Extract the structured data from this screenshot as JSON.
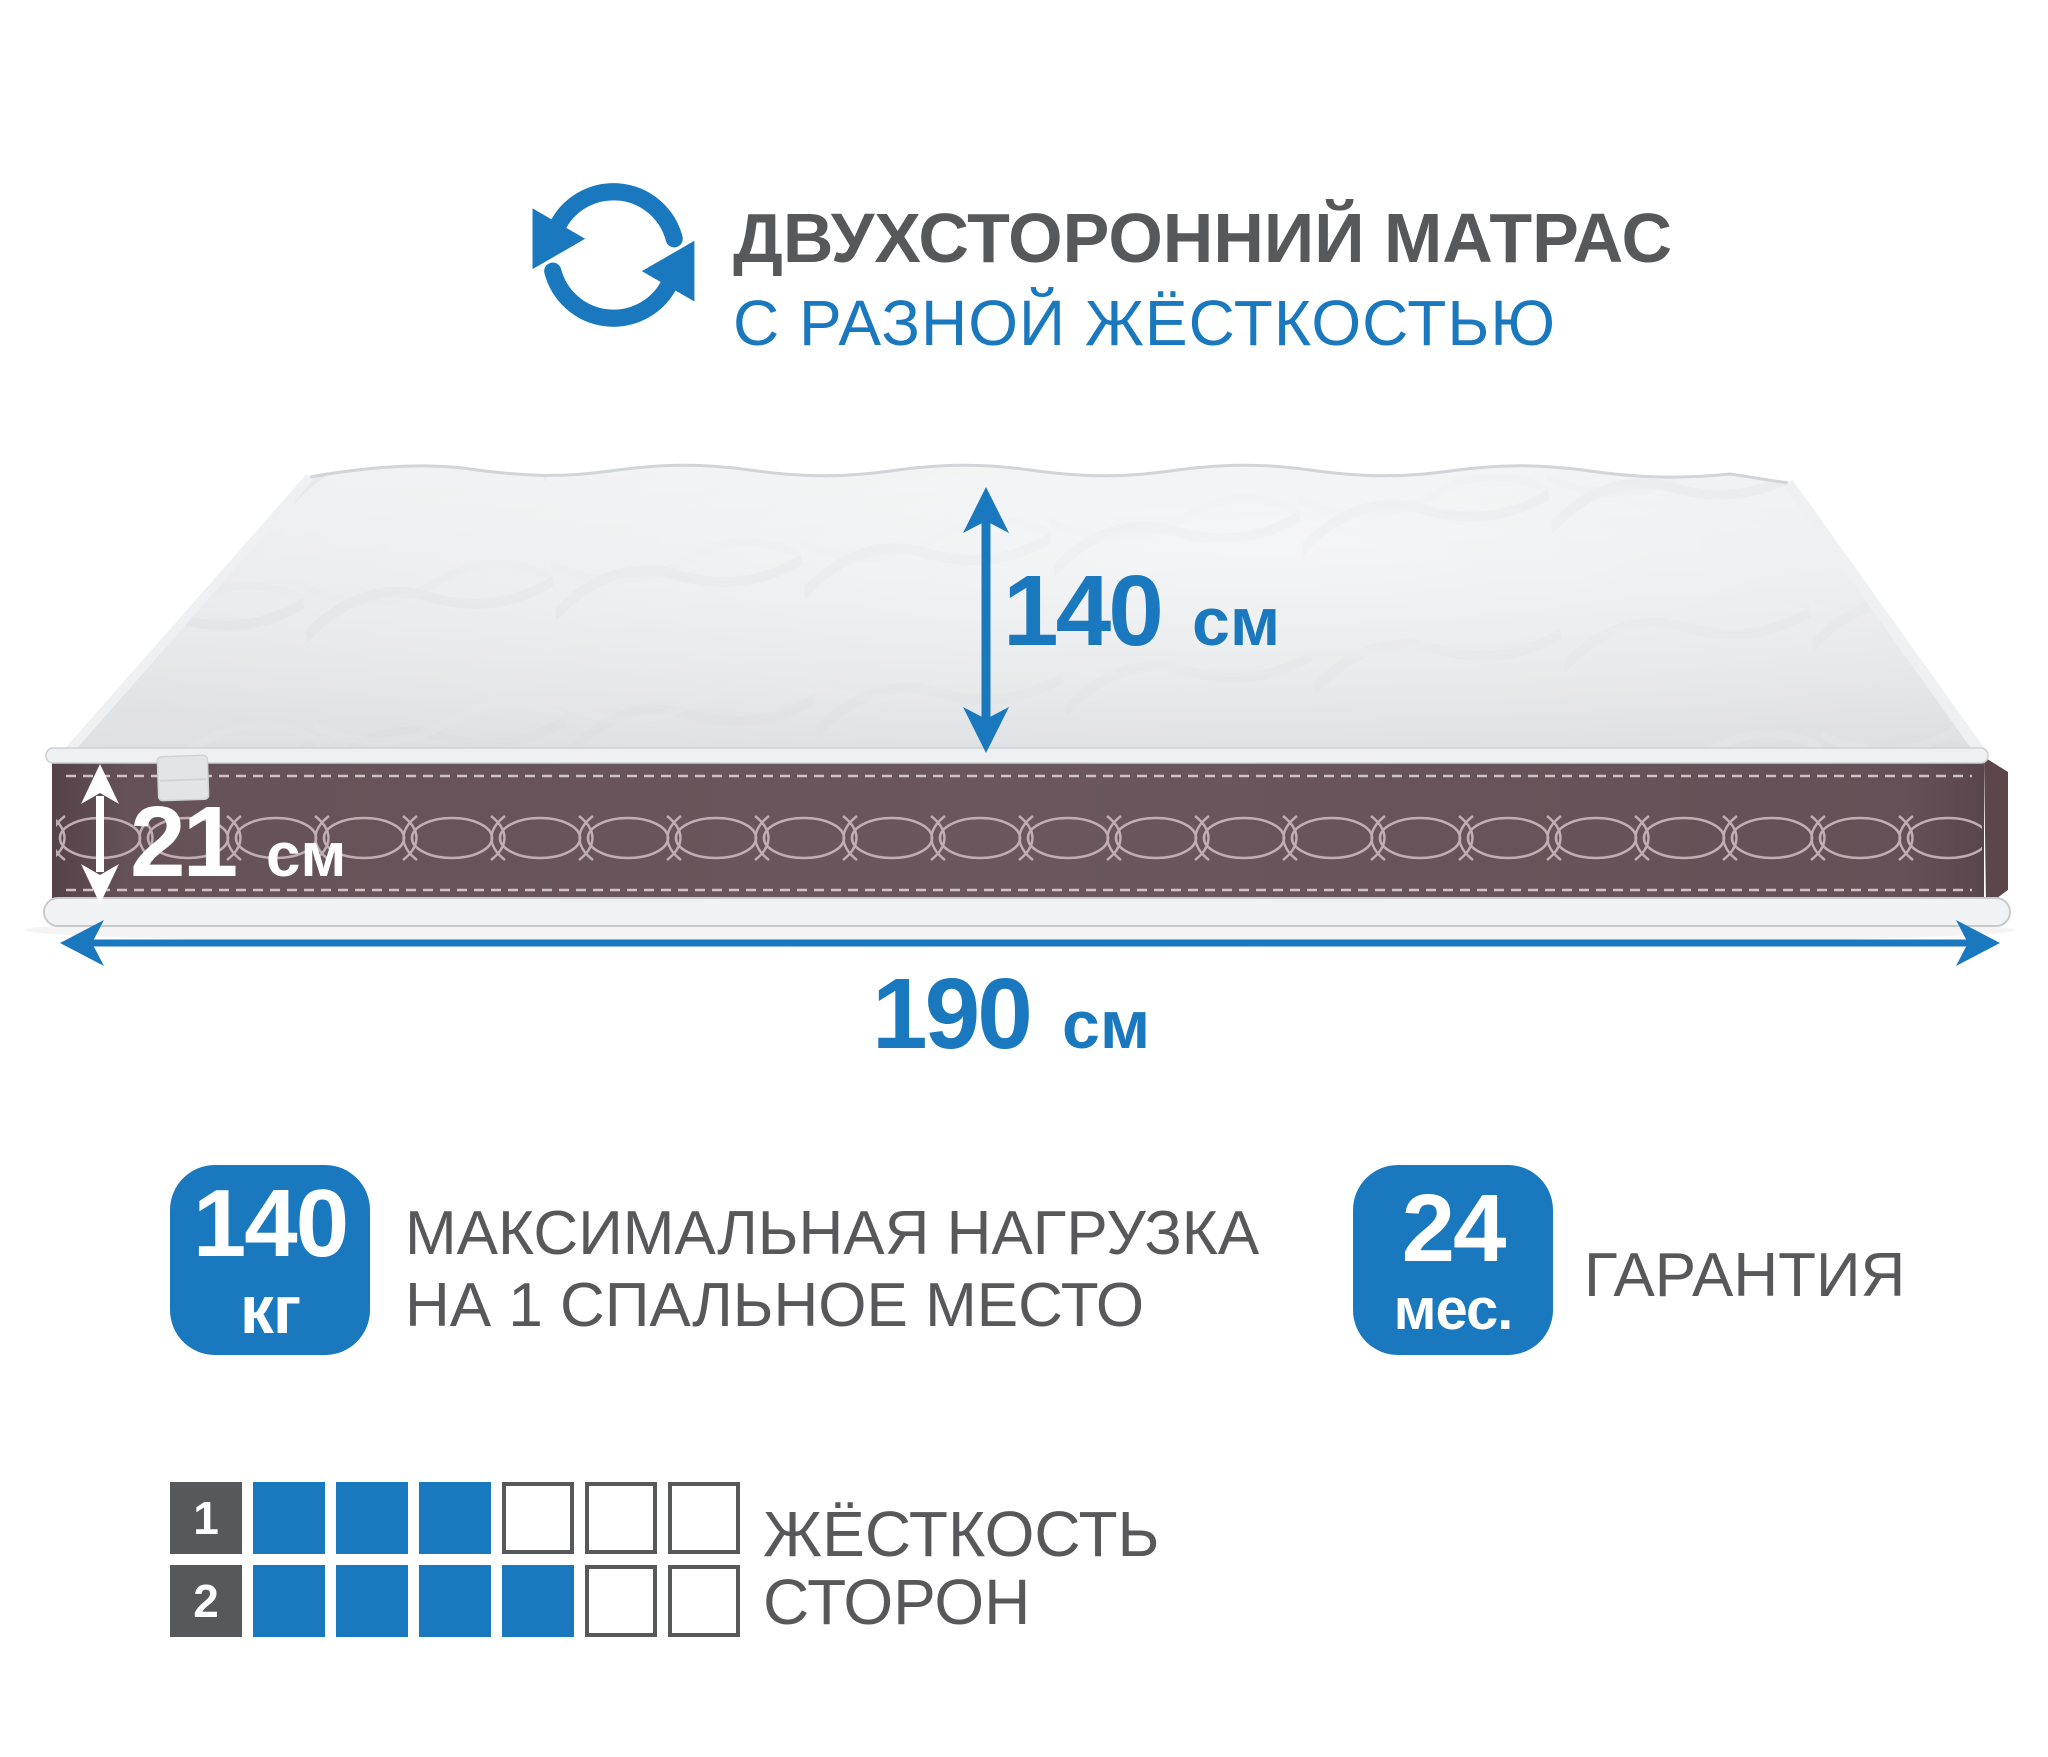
{
  "colors": {
    "accent_blue": "#1a78be",
    "text_gray": "#58585a",
    "mattress_side": "#6a575d",
    "mattress_side_dark": "#5c464c",
    "stitch_thread": "#bfaeb4",
    "top_surface": "#e8eaec",
    "piping_white": "#f0f2f3"
  },
  "header": {
    "icon": "rotate-arrows-icon",
    "title": "ДВУХСТОРОННИЙ МАТРАС",
    "subtitle": "С РАЗНОЙ ЖЁСТКОСТЬЮ"
  },
  "dimensions": {
    "width": {
      "value": "140",
      "unit": "см"
    },
    "height": {
      "value": "21",
      "unit": "см"
    },
    "length": {
      "value": "190",
      "unit": "см"
    }
  },
  "badges": {
    "max_load": {
      "value": "140",
      "unit": "кг",
      "label_line1": "МАКСИМАЛЬНАЯ НАГРУЗКА",
      "label_line2": "НА 1 СПАЛЬНОЕ МЕСТО"
    },
    "warranty": {
      "value": "24",
      "unit": "мес.",
      "label": "ГАРАНТИЯ"
    }
  },
  "firmness": {
    "label_line1": "ЖЁСТКОСТЬ",
    "label_line2": "СТОРОН",
    "scale_max": 6,
    "rows": [
      {
        "index": "1",
        "filled": 3
      },
      {
        "index": "2",
        "filled": 4
      }
    ]
  }
}
